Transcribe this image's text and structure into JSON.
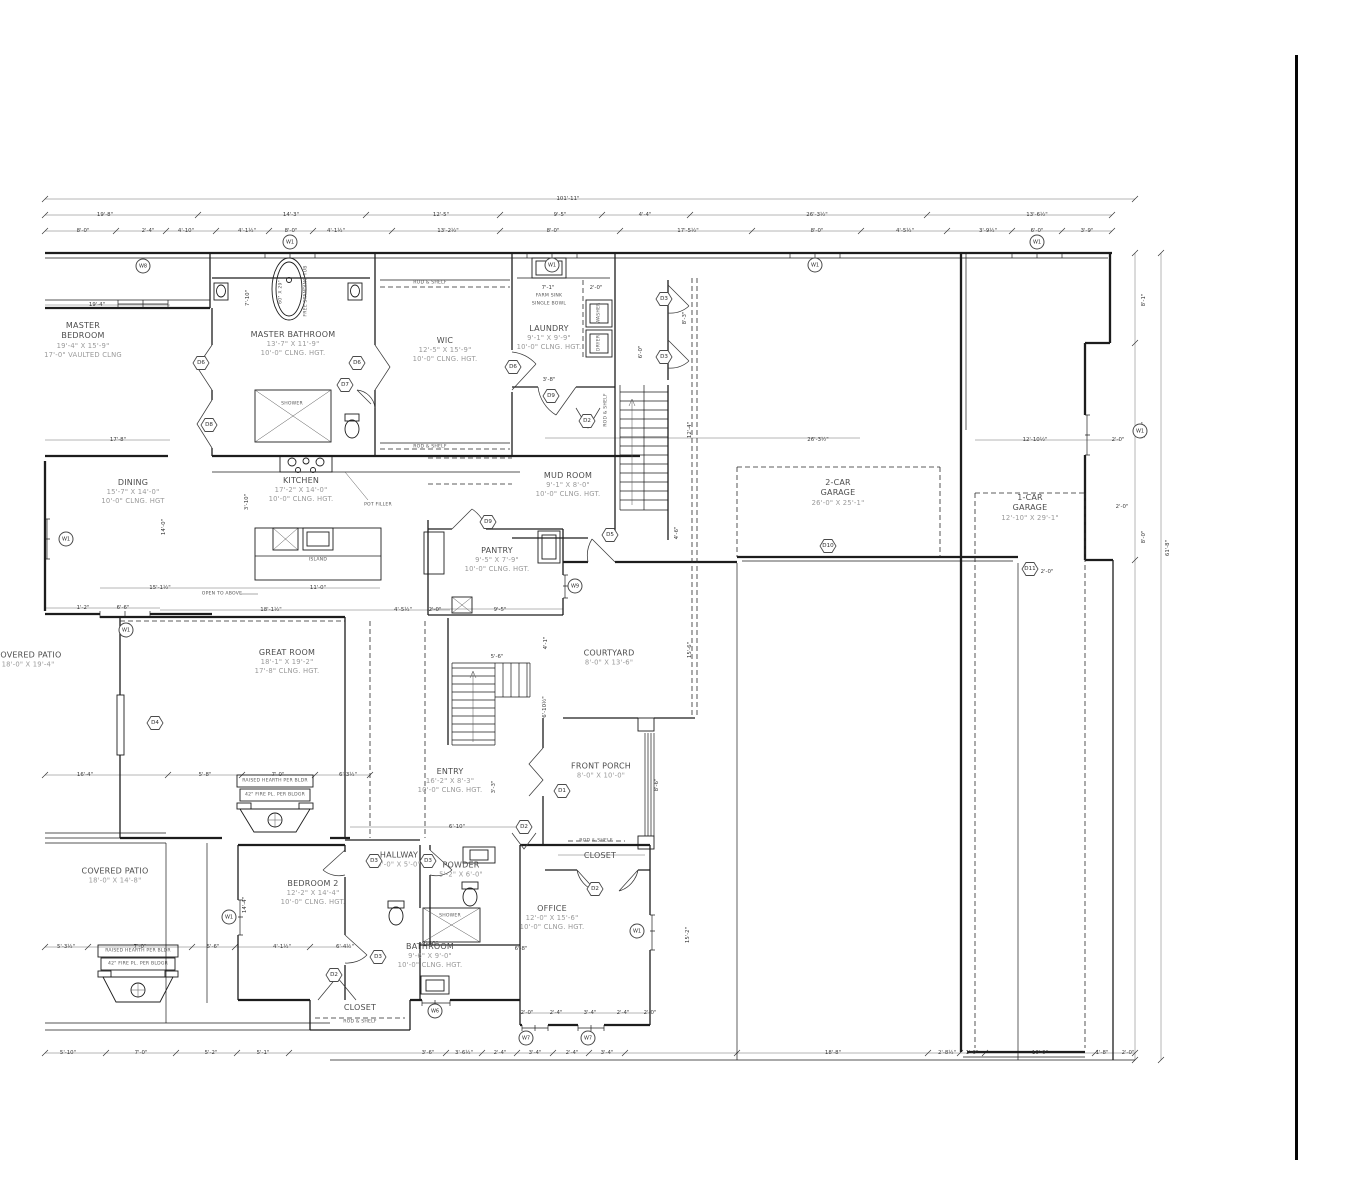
{
  "colors": {
    "line": "#1d1d1d",
    "room_name": "#4c4c4c",
    "room_dim": "#9a9a9a",
    "dim_text": "#3b3b3b",
    "sheet_border": "#050505"
  },
  "rooms": [
    {
      "name": "MASTER",
      "name2": "BEDROOM",
      "size": "19'-4\" X 15'-9\"",
      "clng": "17'-0\" VAULTED CLNG"
    },
    {
      "name": "MASTER BATHROOM",
      "size": "13'-7\" X 11'-9\"",
      "clng": "10'-0\" CLNG. HGT."
    },
    {
      "name": "WIC",
      "size": "12'-5\" X 15'-9\"",
      "clng": "10'-0\" CLNG. HGT."
    },
    {
      "name": "LAUNDRY",
      "size": "9'-1\" X 9'-9\"",
      "clng": "10'-0\" CLNG. HGT."
    },
    {
      "name": "DINING",
      "size": "15'-7\" X 14'-0\"",
      "clng": "10'-0\" CLNG. HGT"
    },
    {
      "name": "KITCHEN",
      "size": "17'-2\" X 14'-0\"",
      "clng": "10'-0\" CLNG. HGT."
    },
    {
      "name": "MUD ROOM",
      "size": "9'-1\" X 8'-0\"",
      "clng": "10'-0\" CLNG. HGT."
    },
    {
      "name": "PANTRY",
      "size": "9'-5\" X 7'-9\"",
      "clng": "10'-0\" CLNG. HGT."
    },
    {
      "name": "2-CAR",
      "name2": "GARAGE",
      "size": "26'-0\" X 25'-1\""
    },
    {
      "name": "1-CAR",
      "name2": "GARAGE",
      "size": "12'-10\" X 29'-1\""
    },
    {
      "name": "GREAT ROOM",
      "size": "18'-1\" X 19'-2\"",
      "clng": "17'-8\" CLNG. HGT."
    },
    {
      "name": "COURTYARD",
      "size": "8'-0\" X 13'-6\""
    },
    {
      "name": "COVERED PATIO",
      "size": "18'-0\" X 19'-4\""
    },
    {
      "name": "ENTRY",
      "size": "16'-2\" X 8'-3\"",
      "clng": "10'-0\" CLNG. HGT."
    },
    {
      "name": "FRONT PORCH",
      "size": "8'-0\" X 10'-0\""
    },
    {
      "name": "HALLWAY",
      "size": "4'-0\" X 5'-0\""
    },
    {
      "name": "POWDER",
      "size": "5'-2\" X 6'-0\""
    },
    {
      "name": "CLOSET"
    },
    {
      "name": "OFFICE",
      "size": "12'-0\" X 15'-6\"",
      "clng": "10'-0\" CLNG. HGT."
    },
    {
      "name": "COVERED PATIO",
      "size": "18'-0\" X 14'-8\""
    },
    {
      "name": "BEDROOM 2",
      "size": "12'-2\" X 14'-4\"",
      "clng": "10'-0\" CLNG. HGT."
    },
    {
      "name": "BATHROOM",
      "size": "9'-6\" X 9'-0\"",
      "clng": "10'-0\" CLNG. HGT."
    },
    {
      "name": "CLOSET"
    }
  ],
  "doors": [
    "D6",
    "D8",
    "D6",
    "D7",
    "D6",
    "D9",
    "D2",
    "D3",
    "D3",
    "D5",
    "D9",
    "D10",
    "D11",
    "D4",
    "D1",
    "D2",
    "D2",
    "D3",
    "D3",
    "D3",
    "D2"
  ],
  "windows": [
    "W8",
    "W1",
    "W1",
    "W1",
    "W1",
    "W1",
    "W1",
    "W9",
    "W1",
    "W1",
    "W1",
    "W6",
    "W7",
    "W7"
  ],
  "dims": [
    "101'-11\"",
    "19'-8\"",
    "14'-3\"",
    "12'-5\"",
    "9'-5\"",
    "4'-4\"",
    "26'-3½\"",
    "13'-6½\"",
    "8'-0\"",
    "2'-4\"",
    "4'-10\"",
    "4'-1½\"",
    "8'-0\"",
    "4'-1½\"",
    "13'-2½\"",
    "8'-0\"",
    "17'-5½\"",
    "8'-0\"",
    "4'-5½\"",
    "3'-9½\"",
    "6'-0\"",
    "3'-9\"",
    "19'-4\"",
    "17'-8\"",
    "7'-10\"",
    "8'-3\"",
    "6'-0\"",
    "3'-8\"",
    "12'-4\"",
    "26'-3½\"",
    "12'-10½\"",
    "2'-0\"",
    "8'-1\"",
    "13'-6\"",
    "2'-0\"",
    "8'-0\"",
    "61'-8\"",
    "15'-1½\"",
    "11'-0\"",
    "1'-2\"",
    "6'-6\"",
    "18'-1½\"",
    "4'-5½\"",
    "2'-0\"",
    "14'-0\"",
    "3'-10\"",
    "9'-5\"",
    "4'-6\"",
    "15'-6\"",
    "6'-10½\"",
    "5'-6\"",
    "16'-4\"",
    "5'-8\"",
    "7'-0\"",
    "6'-3½\"",
    "6'-10\"",
    "3'-3\"",
    "8'-6\"",
    "15'-2\"",
    "5'-3½\"",
    "7'-0\"",
    "5'-6\"",
    "4'-1½\"",
    "6'-4½\"",
    "5'-10\"",
    "7'-0\"",
    "5'-2\"",
    "5'-1\"",
    "3'-6\"",
    "3'-6½\"",
    "2'-4\"",
    "3'-4\"",
    "2'-4\"",
    "3'-4\"",
    "18'-8\"",
    "2'-8½\"",
    "1'-0\"",
    "10'-0\"",
    "1'-8\"",
    "2'-0\"",
    "2'-0\"",
    "2'-4\"",
    "3'-4\"",
    "2'-4\"",
    "2'-0\"",
    "2'-0\"",
    "7'-1\"",
    "2'-0\"",
    "14'-4\"",
    "9'-10\"",
    "6'-8\"",
    "4'-1\""
  ],
  "small": {
    "shower": "SHOWER",
    "island": "ISLAND",
    "pot_filler": "POT FILLER",
    "open_above": "OPEN TO ABOVE",
    "rod_shelf": "ROD & SHELF",
    "farm_sink": "FARM SINK",
    "single_bowl": "SINGLE BOWL",
    "washer": "WASHER",
    "dryer": "DRYER",
    "tub": "FREE STANDING TUB",
    "tub_size": "60\" X 29\"",
    "hearth": "RAISED HEARTH PER BLDR",
    "fireplace": "42\" FIRE PL. PER BLDGR"
  }
}
